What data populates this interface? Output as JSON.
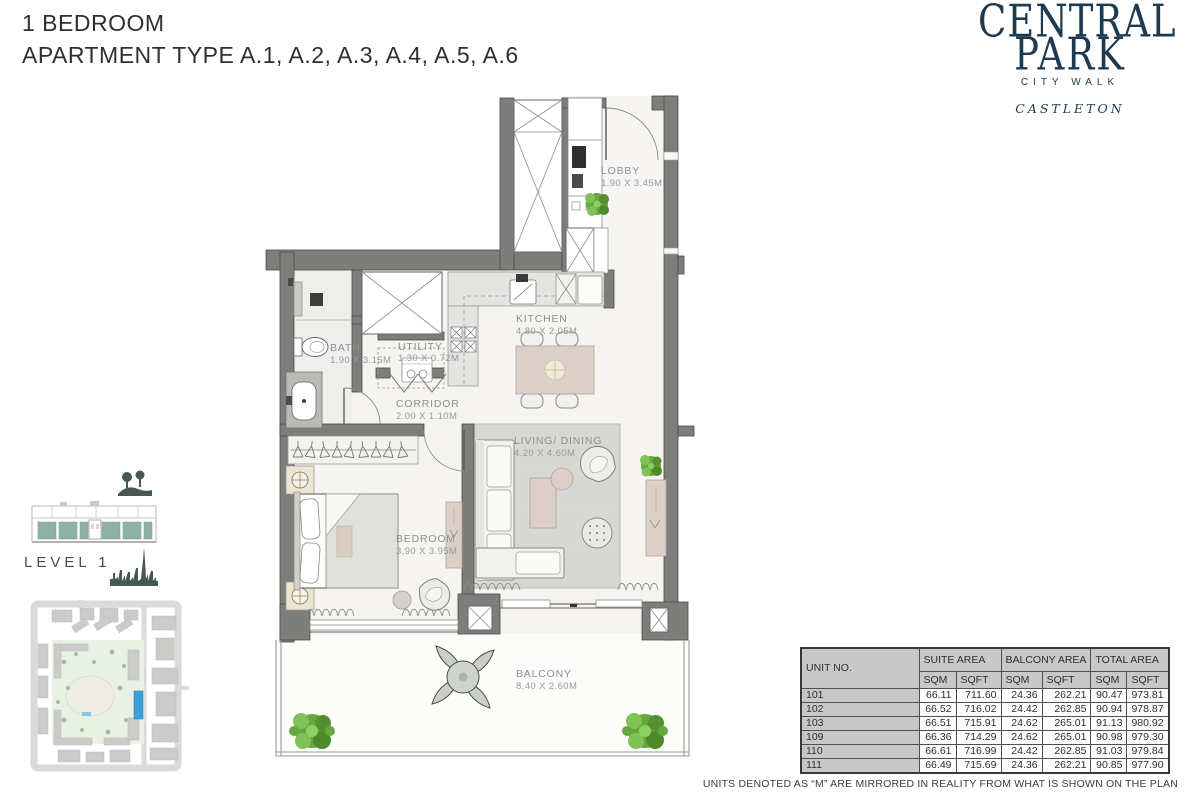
{
  "header": {
    "title_line1": "1 BEDROOM",
    "title_line2": "APARTMENT TYPE A.1, A.2, A.3, A.4, A.5, A.6"
  },
  "logo": {
    "line1": "CENTRAL",
    "line2": "PARK",
    "subtitle": "CITY WALK",
    "brand": "CASTLETON"
  },
  "level": {
    "label": "LEVEL 1"
  },
  "plan": {
    "rooms": [
      {
        "name": "LOBBY",
        "dims": "1.90 X 3.45M"
      },
      {
        "name": "KITCHEN",
        "dims": "4.80 X 2.05M"
      },
      {
        "name": "BATH",
        "dims": "1.90 X 3.15M"
      },
      {
        "name": "UTILITY",
        "dims": "1.30 X 0.72M"
      },
      {
        "name": "CORRIDOR",
        "dims": "2.00 X 1.10M"
      },
      {
        "name": "LIVING/ DINING",
        "dims": "4.20 X 4.60M"
      },
      {
        "name": "BEDROOM",
        "dims": "3.90 X 3.95M"
      },
      {
        "name": "BALCONY",
        "dims": "8.40 X 2.60M"
      }
    ]
  },
  "area_table": {
    "col_unit": "UNIT NO.",
    "group_suite": "SUITE AREA",
    "group_balcony": "BALCONY AREA",
    "group_total": "TOTAL AREA",
    "sqm": "SQM",
    "sqft": "SQFT",
    "rows": [
      {
        "unit": "101",
        "suite_sqm": "66.11",
        "suite_sqft": "711.60",
        "balcony_sqm": "24.36",
        "balcony_sqft": "262.21",
        "total_sqm": "90.47",
        "total_sqft": "973.81"
      },
      {
        "unit": "102",
        "suite_sqm": "66.52",
        "suite_sqft": "716.02",
        "balcony_sqm": "24.42",
        "balcony_sqft": "262.85",
        "total_sqm": "90.94",
        "total_sqft": "978.87"
      },
      {
        "unit": "103",
        "suite_sqm": "66.51",
        "suite_sqft": "715.91",
        "balcony_sqm": "24.62",
        "balcony_sqft": "265.01",
        "total_sqm": "91.13",
        "total_sqft": "980.92"
      },
      {
        "unit": "109",
        "suite_sqm": "66.36",
        "suite_sqft": "714.29",
        "balcony_sqm": "24.62",
        "balcony_sqft": "265.01",
        "total_sqm": "90.98",
        "total_sqft": "979.30"
      },
      {
        "unit": "110",
        "suite_sqm": "66.61",
        "suite_sqft": "716.99",
        "balcony_sqm": "24.42",
        "balcony_sqft": "262.85",
        "total_sqm": "91.03",
        "total_sqft": "979.84"
      },
      {
        "unit": "111",
        "suite_sqm": "66.49",
        "suite_sqft": "715.69",
        "balcony_sqm": "24.36",
        "balcony_sqft": "262.21",
        "total_sqm": "90.85",
        "total_sqft": "977.90"
      }
    ]
  },
  "footnote": "UNITS DENOTED AS “M” ARE MIRRORED IN REALITY FROM WHAT IS SHOWN ON THE PLAN",
  "colors": {
    "brand_navy": "#1d3a50",
    "wall_gray": "#7d7d7b",
    "level_teal": "#8fb0a5",
    "site_highlight_blue": "#3e9fd9",
    "plant_green": "#66a83e"
  }
}
